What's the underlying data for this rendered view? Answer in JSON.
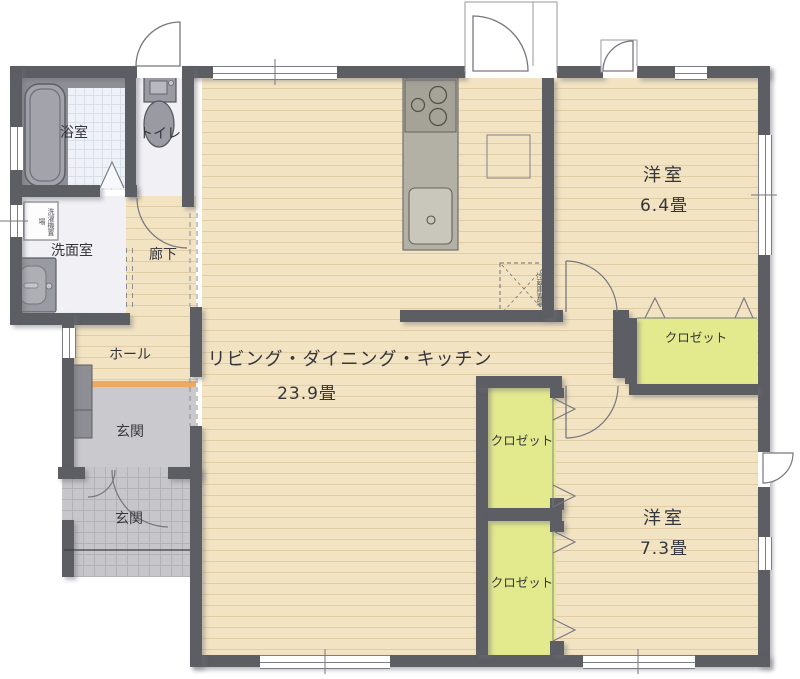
{
  "plan": {
    "rooms": {
      "bathroom": {
        "label": "浴室"
      },
      "toilet": {
        "label": "トイレ"
      },
      "washroom": {
        "label": "洗面室"
      },
      "corridor": {
        "label": "廊下"
      },
      "hall": {
        "label": "ホール"
      },
      "entrance_hall": {
        "label": "玄関"
      },
      "entrance_porch": {
        "label": "玄関"
      },
      "ldk": {
        "label": "リビング・ダイニング・キッチン",
        "size": "23.9畳"
      },
      "bedroom_1": {
        "label": "洋室",
        "size": "6.4畳"
      },
      "bedroom_2": {
        "label": "洋室",
        "size": "7.3畳"
      }
    },
    "closets": [
      {
        "label": "クロゼット"
      },
      {
        "label": "クロゼット"
      },
      {
        "label": "クロゼット"
      }
    ],
    "fixtures": {
      "refrigerator_space": "冷蔵庫置場",
      "washing_machine_space": "洗濯機置場"
    },
    "colors": {
      "wall": "#5d5d64",
      "wood_floor": "#f2e3c2",
      "closet": "#e3ea8e",
      "entrance_step": "#eda864",
      "porch_tile": "#c7c7cb",
      "bath_tile": "#eef1f7"
    }
  }
}
